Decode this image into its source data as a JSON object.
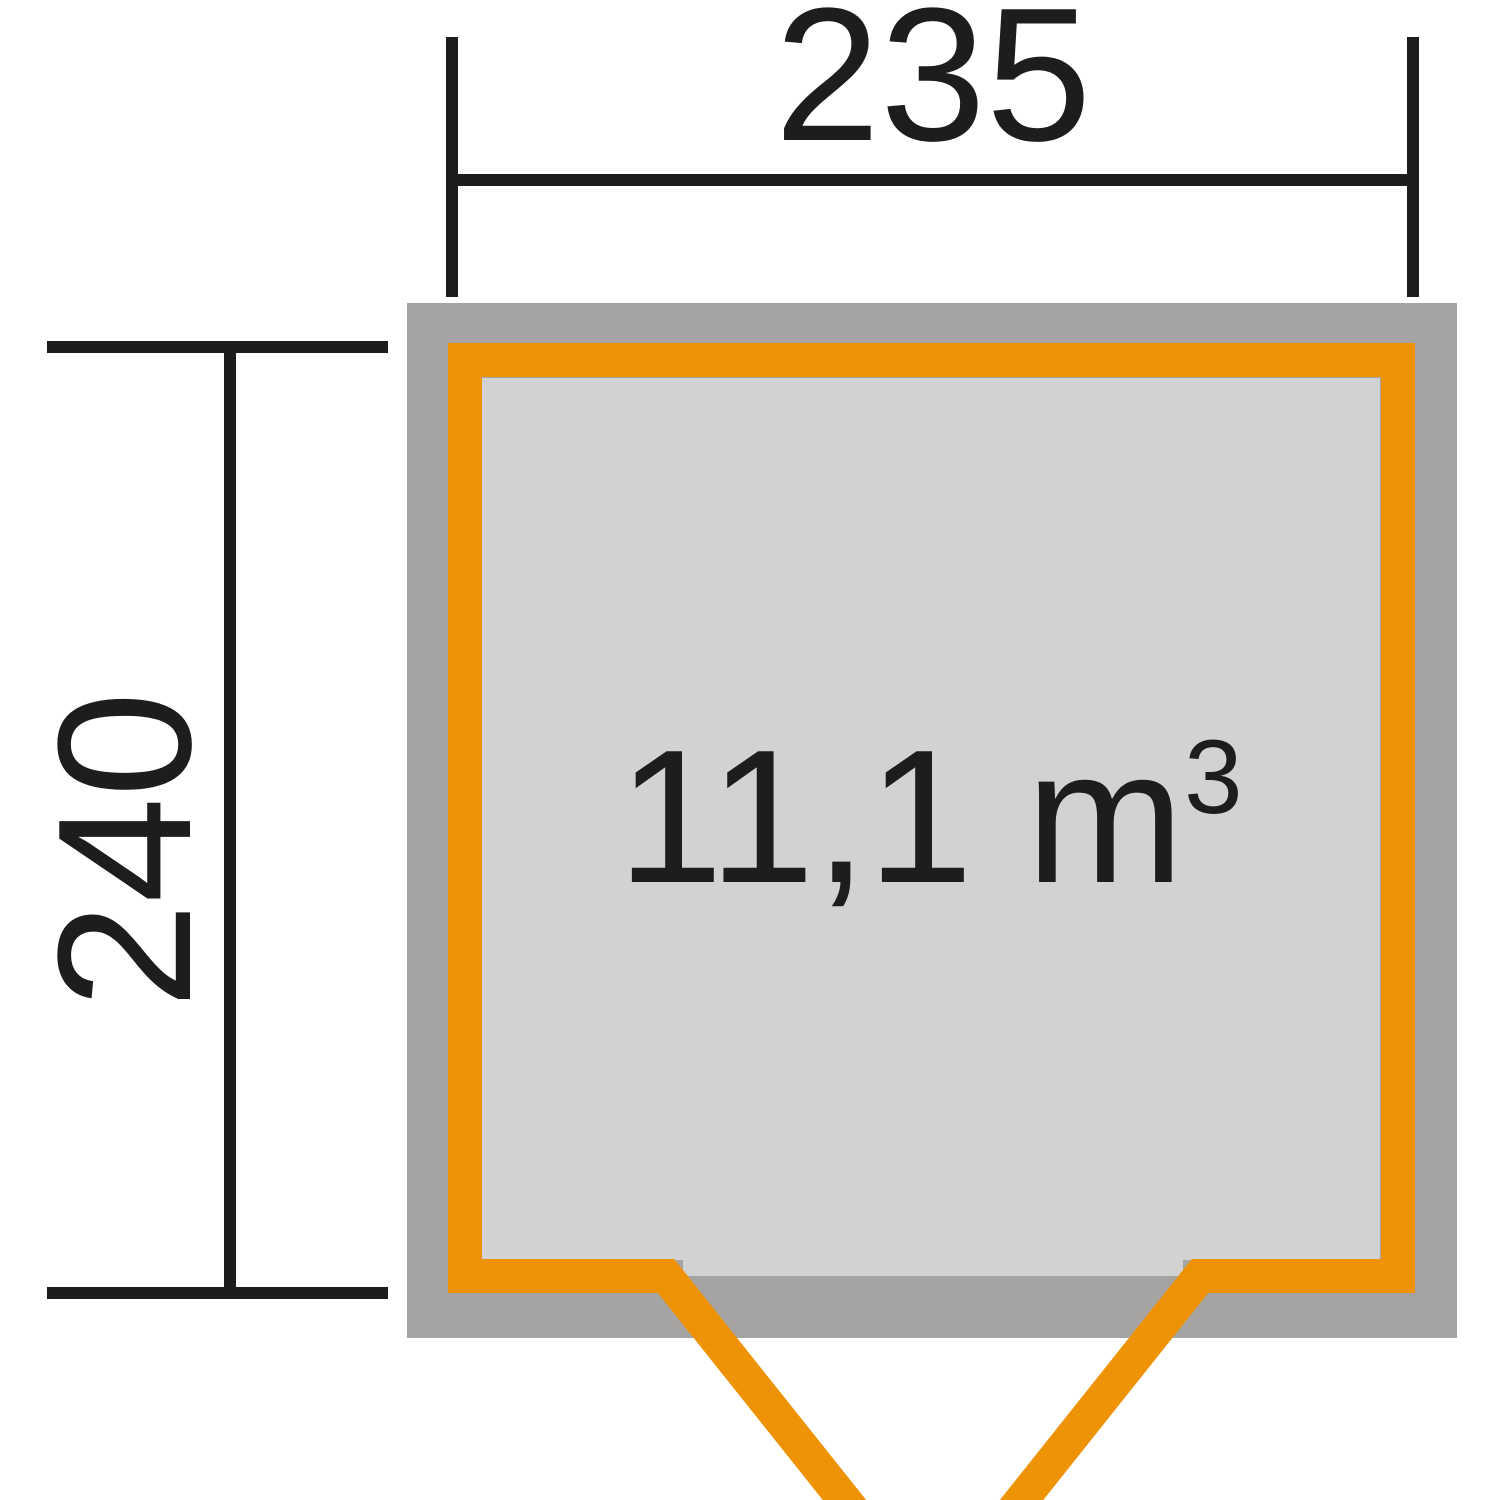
{
  "diagram": {
    "type": "shed-floor-plan",
    "width_dimension": {
      "label": "235"
    },
    "height_dimension": {
      "label": "240"
    },
    "volume_label": "11,1 m",
    "volume_exponent": "3"
  },
  "colors": {
    "background": "#ffffff",
    "line_black": "#1d1d1b",
    "wall_orange": "#ee9306",
    "body_gray": "#a6a3a3",
    "interior_gray": "#d3d2d2"
  }
}
